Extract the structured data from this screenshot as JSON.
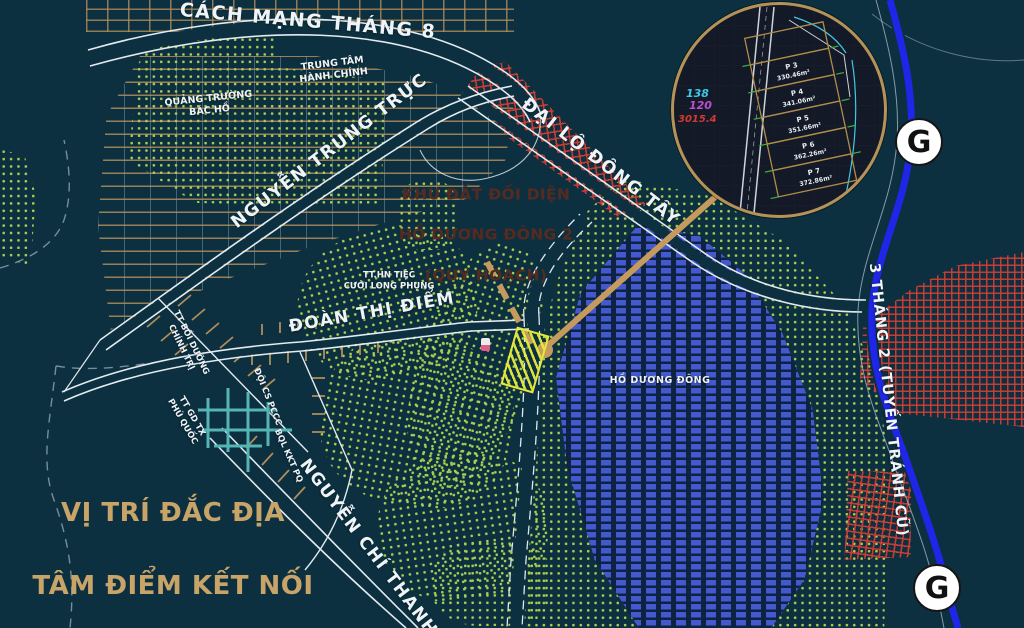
{
  "map": {
    "slogan": {
      "line1": "VỊ TRÍ ĐẮC ĐỊA",
      "line2": "TÂM ĐIỂM KẾT NỐI",
      "color": "#c8a469"
    },
    "callout": {
      "line1": "KHU ĐẤT ĐỐI DIỆN",
      "line2": "HỒ DƯƠNG ĐÔNG 2",
      "line3": "(QUY HOẠCH)",
      "color": "#572a20"
    },
    "streets": {
      "cach_mang_thang_8": "CÁCH MẠNG THÁNG 8",
      "nguyen_trung_truc": "NGUYỄN TRUNG TRỰC",
      "dai_lo_dong_tay": "ĐẠI LỘ ĐÔNG TÂY",
      "doan_thi_diem": "ĐOÀN THỊ ĐIỂM",
      "nguyen_chi_thanh": "NGUYỄN CHÍ THANH",
      "ba_thang_hai": "3 THÁNG 2 (TUYẾN TRÁNH CŨ)"
    },
    "places": {
      "admin_center": "TRUNG TÂM\nHÀNH CHÍNH",
      "bac_ho_square": "QUẢNG TRƯỜNG\nBÁC HỒ",
      "wedding_center": "TT.HN TIỆC\nCƯỚI LONG PHỤNG",
      "politics_training_center": "TT BỒI DƯỠNG\nCHÍNH TRỊ",
      "continuing_education_center": "TT GD TX\nPHÚ QUỐC",
      "fire_police_unit": "ĐỘI CS PCCC",
      "economic_zone_board": "BQL KKT PQ"
    },
    "lake_label": "HỒ DƯƠNG ĐÔNG",
    "g_marker": "G",
    "inset": {
      "refs": [
        {
          "value": "138",
          "color": "#3ec9ea"
        },
        {
          "value": "120",
          "color": "#c04fd0"
        },
        {
          "value": "3015.4",
          "color": "#d23a30"
        }
      ],
      "plots": [
        {
          "name": "P 3",
          "area": "330.46m²"
        },
        {
          "name": "P 4",
          "area": "341.06m²"
        },
        {
          "name": "P 5",
          "area": "351.66m²"
        },
        {
          "name": "P 6",
          "area": "362.26m²"
        },
        {
          "name": "P 7",
          "area": "372.86m²"
        }
      ]
    },
    "colors": {
      "background": "#0c3040",
      "road_blue": "#2026e8",
      "arrow_gold": "#c49a5d",
      "hatch_red": "#ce3e34",
      "dots_green": "#a8cd50",
      "lake_blue": "#4459ce"
    }
  }
}
